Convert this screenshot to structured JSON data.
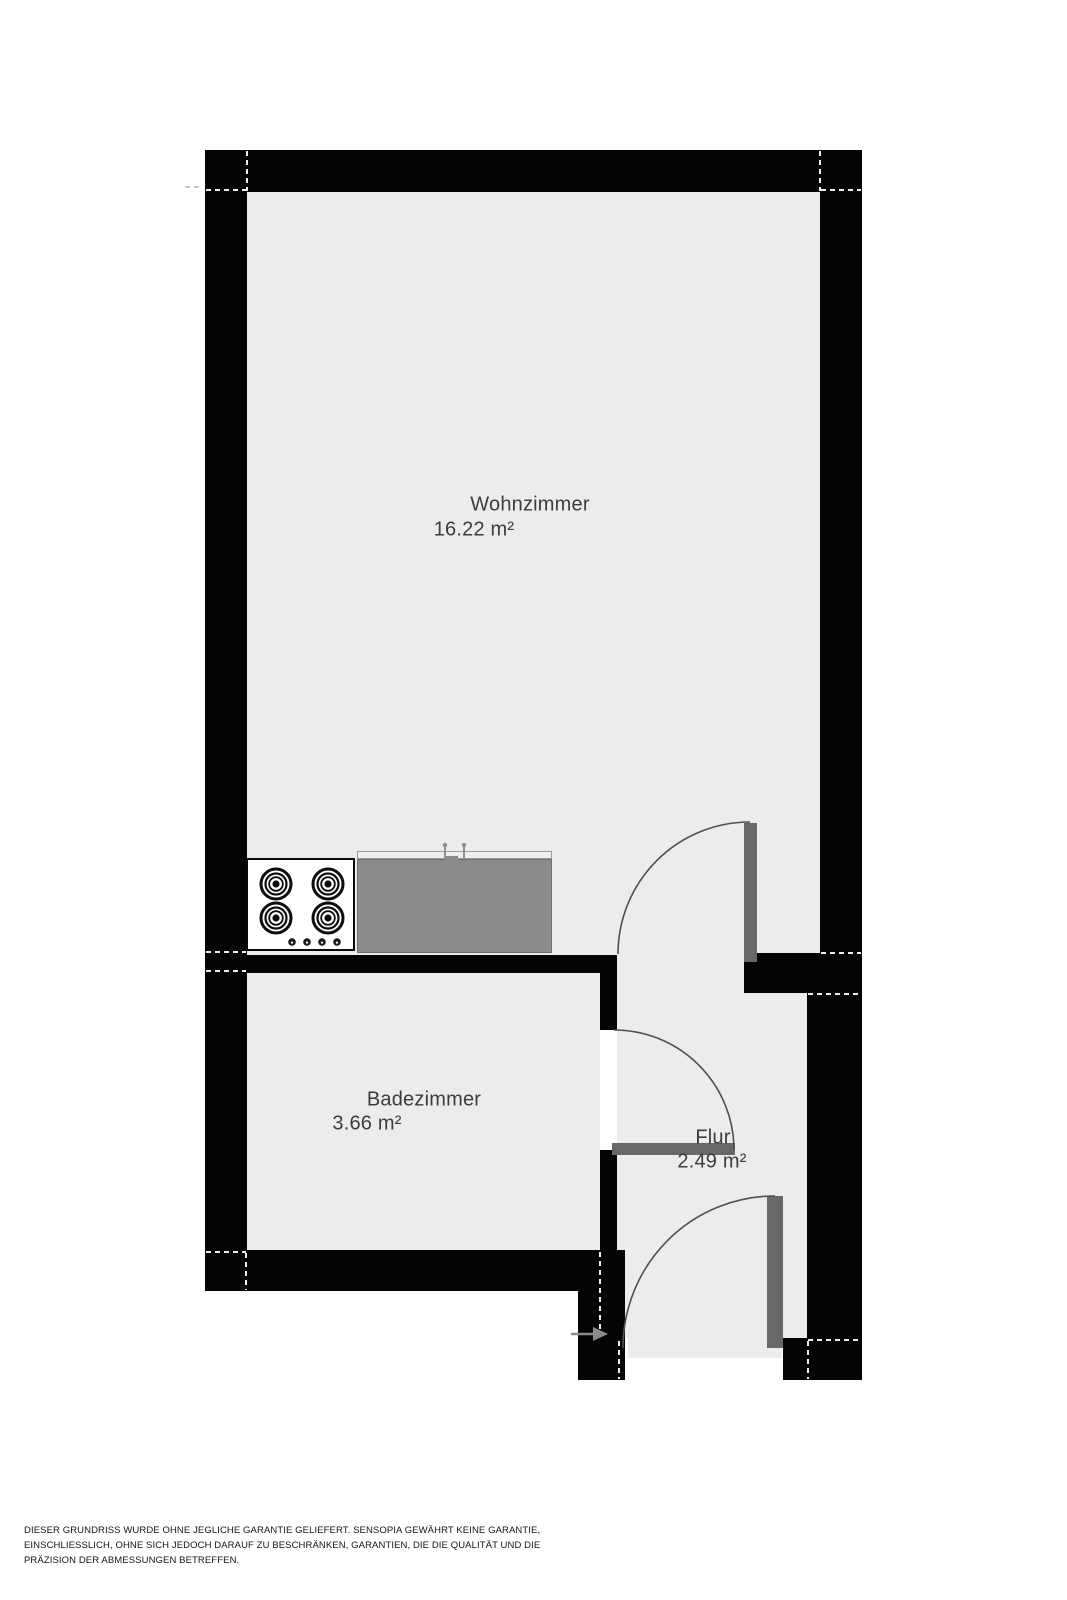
{
  "plan": {
    "rooms": [
      {
        "name": "Wohnzimmer",
        "area": "16.22 m²"
      },
      {
        "name": "Badezimmer",
        "area": "3.66 m²"
      },
      {
        "name": "Flur",
        "area": "2.49 m²"
      }
    ],
    "fixtures": {
      "stove_burner_count": 4,
      "icons": [
        "stove-cooktop-icon",
        "kitchen-counter",
        "entrance-arrow-icon",
        "door-swing-arc"
      ]
    },
    "colors": {
      "wall": "#040404",
      "floor": "#ececec",
      "counter": "#8b8b8b",
      "door_leaf": "#686868",
      "swing_arc": "#4f4f4f",
      "label_text": "#3c3c3c",
      "cut_marks": "#ededed"
    }
  },
  "disclaimer": {
    "lines": [
      "DIESER GRUNDRISS WURDE OHNE JEGLICHE GARANTIE GELIEFERT. SENSOPIA GEWÄHRT KEINE GARANTIE,",
      "EINSCHLIESSLICH, OHNE SICH JEDOCH DARAUF ZU BESCHRÄNKEN, GARANTIEN, DIE DIE QUALITÄT UND DIE",
      "PRÄZISION DER ABMESSUNGEN BETREFFEN."
    ]
  }
}
